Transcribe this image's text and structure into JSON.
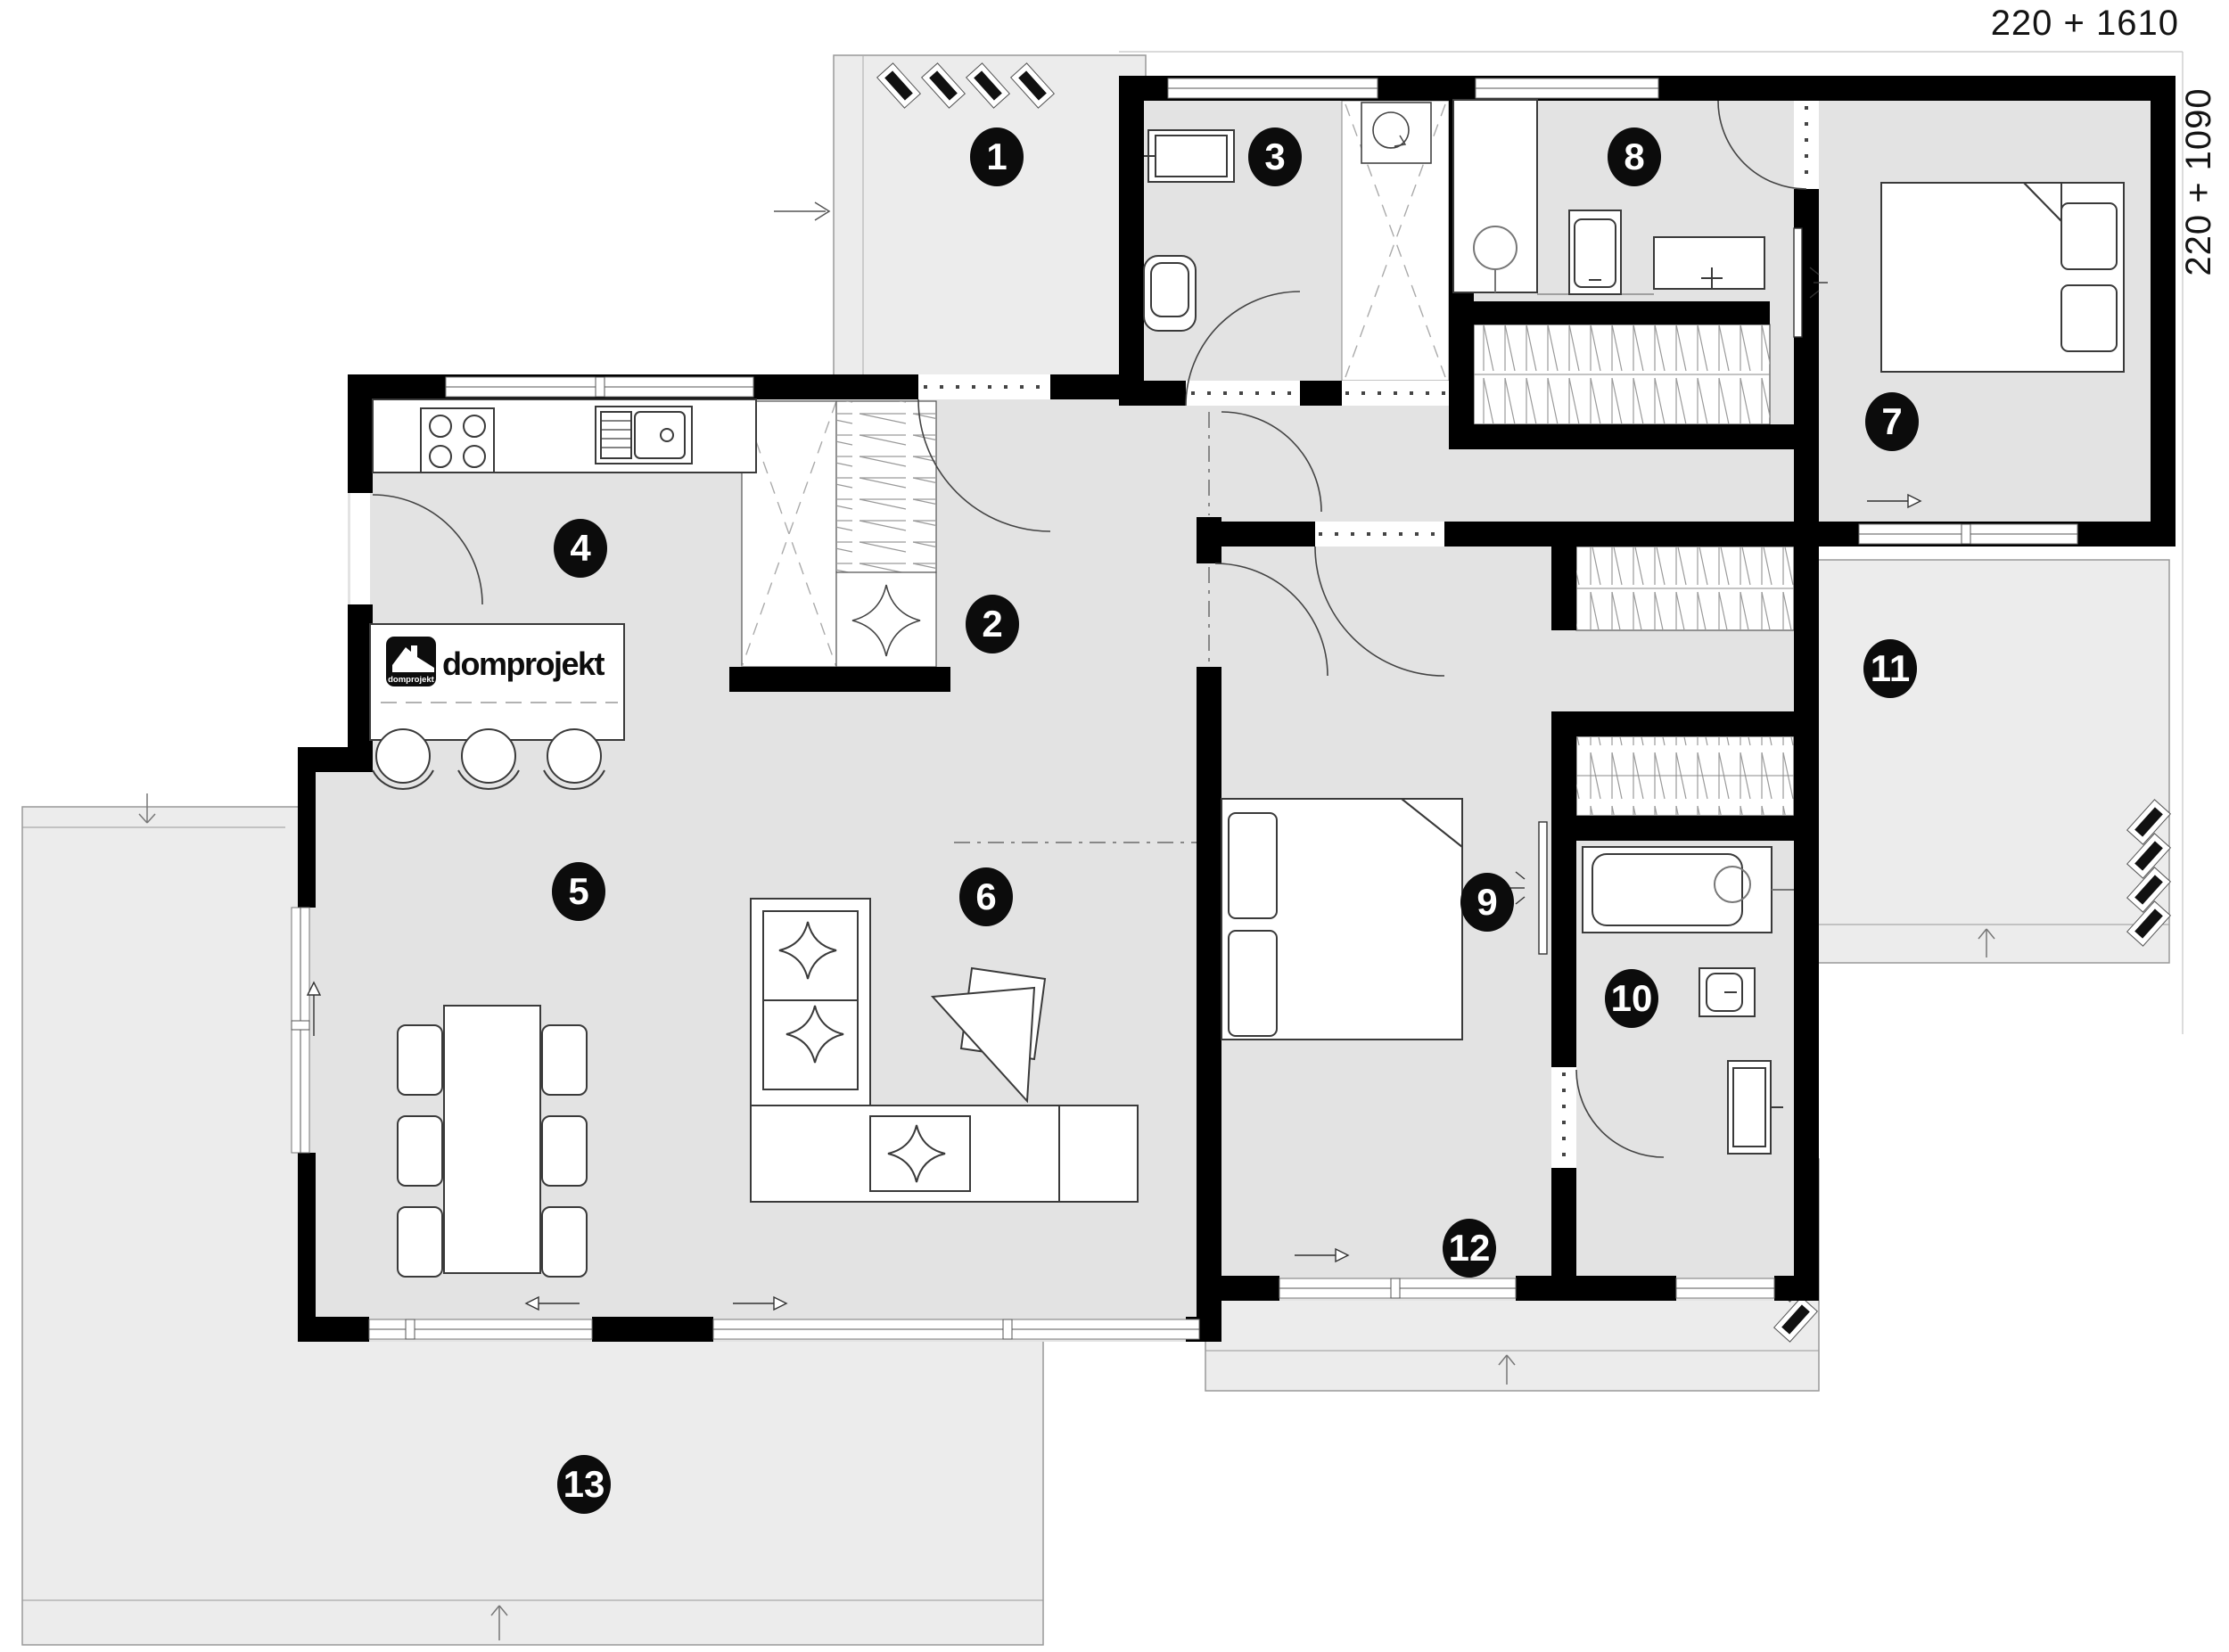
{
  "dimensions": {
    "top_right": "220 + 1610",
    "right_side": "220 + 1090"
  },
  "logo": {
    "brand": "domprojekt",
    "icon_label": "domprojekt"
  },
  "rooms": [
    "1",
    "2",
    "3",
    "4",
    "5",
    "6",
    "7",
    "8",
    "9",
    "10",
    "11",
    "12",
    "13"
  ],
  "colors": {
    "wall": "#000000",
    "room_fill": "#e3e3e3",
    "terrace_fill": "#ececec",
    "badge_bg": "#0c0c0c",
    "badge_text": "#ffffff",
    "furniture_stroke": "#3a3a3a"
  }
}
